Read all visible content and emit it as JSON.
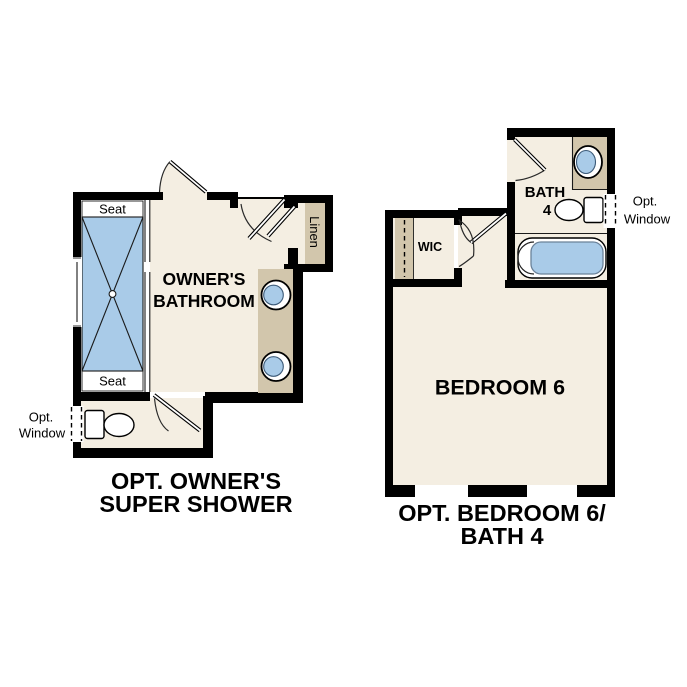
{
  "title": "Floor plan options detail",
  "colors": {
    "background": "#FFFFFF",
    "wall": "#000000",
    "floor_cream": "#F4EEE2",
    "counter_tan": "#D2C6AC",
    "fixture_blue": "#A9CBE8"
  },
  "left_plan": {
    "caption": {
      "line1": "OPT. OWNER'S",
      "line2": "SUPER SHOWER"
    },
    "room_label": {
      "line1": "OWNER'S",
      "line2": "BATHROOM"
    },
    "shower": {
      "seat_top": "Seat",
      "seat_bottom": "Seat"
    },
    "linen_label": "Linen",
    "opt_window": {
      "line1": "Opt.",
      "line2": "Window"
    }
  },
  "right_plan": {
    "caption": {
      "line1": "OPT. BEDROOM 6/",
      "line2": "BATH 4"
    },
    "bedroom_label": "BEDROOM 6",
    "bath_label": {
      "line1": "BATH",
      "line2": "4"
    },
    "wic_label": "WIC",
    "opt_window": {
      "line1": "Opt.",
      "line2": "Window"
    }
  }
}
